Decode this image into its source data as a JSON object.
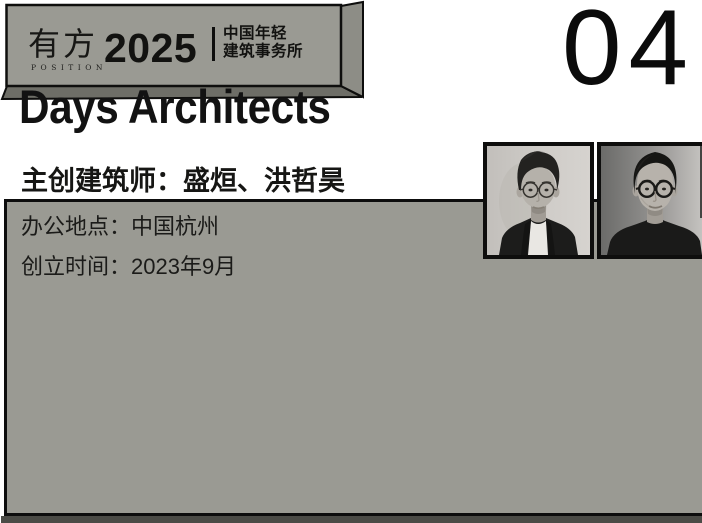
{
  "page": {
    "number": "04",
    "background_color": "#ffffff"
  },
  "banner": {
    "logo_cn": "有方",
    "logo_en": "POSITION",
    "year": "2025",
    "tagline_line1": "中国年轻",
    "tagline_line2": "建筑事务所",
    "colors": {
      "face": "#9a9a93",
      "side": "#8d8d86",
      "bottom": "#6e6e67",
      "outline": "#0e0e0d"
    }
  },
  "card": {
    "firm_name": "Days Architects",
    "architects_line": "主创建筑师：盛烜、洪哲昊",
    "location_line": "办公地点：中国杭州",
    "founded_line": "创立时间：2023年9月",
    "colors": {
      "background": "#9a9a93",
      "border": "#0d0d0d",
      "shadow": "#4b4b46",
      "text": "#141412"
    }
  },
  "photos": {
    "left": "black-and-white portrait, architect with glasses, dark blazer, white shirt",
    "right": "black-and-white portrait, architect with glasses, dark sweater"
  }
}
